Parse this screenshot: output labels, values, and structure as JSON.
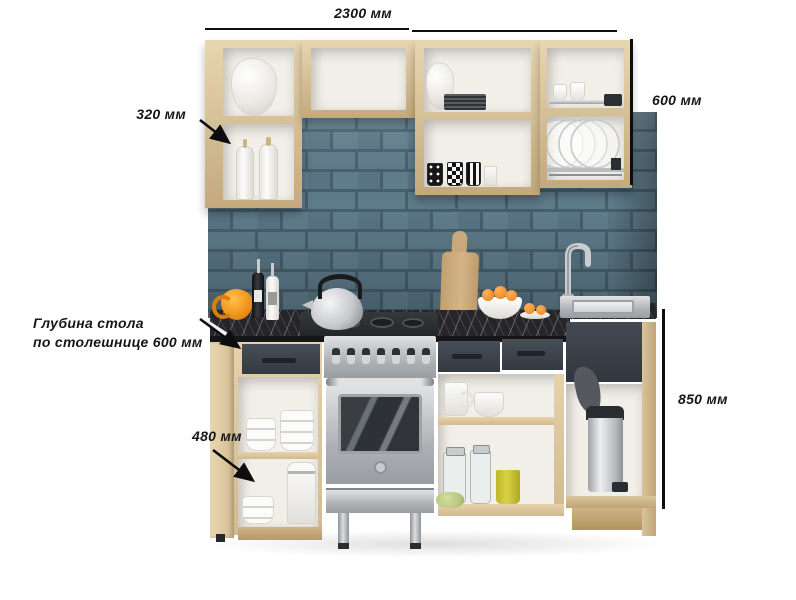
{
  "annotations": {
    "total_width": "2300 мм",
    "wall_cabinet_height": "600 мм",
    "wall_cabinet_depth": "320 мм",
    "counter_depth_line1": "Глубина стола",
    "counter_depth_line2": "по  столешнице 600 мм",
    "base_cabinet_depth": "480 мм",
    "base_cabinet_height": "850 мм"
  },
  "colors": {
    "background": "#ffffff",
    "dimension_text": "#16161a",
    "dimension_line": "#0d0d0d",
    "wood": "#dcc79e",
    "wood_light": "#e8d6b0",
    "wood_dark": "#c4a97c",
    "cabinet_interior": "#f2efe8",
    "dark_front": "#3a414a",
    "handle": "#20242a",
    "brick_face": "#5e7b8a",
    "brick_mortar": "#47606d",
    "countertop": "#26262a",
    "steel": "#c6c9cc",
    "steel_dark": "#8e9296",
    "accent_orange": "#f0941c",
    "accent_yellow": "#d9d344",
    "accent_green": "#b6c580"
  }
}
